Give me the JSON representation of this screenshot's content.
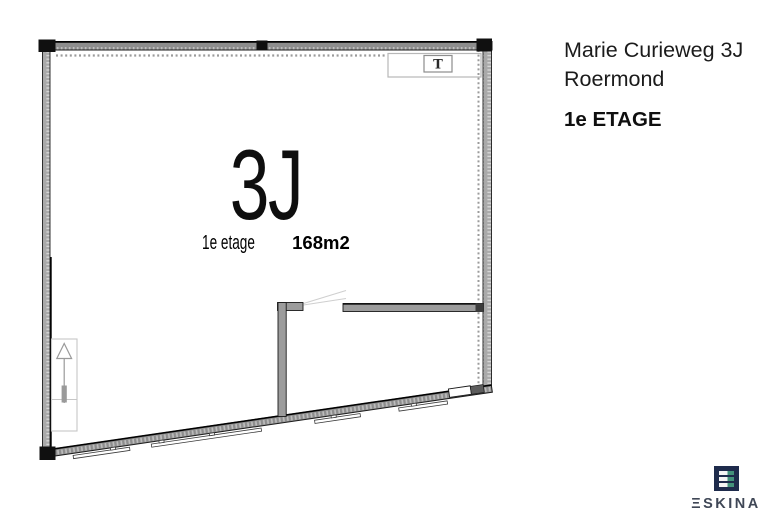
{
  "header": {
    "address_line1": "Marie Curieweg 3J",
    "address_line2": "Roermond",
    "floor_label": "1e ETAGE"
  },
  "plan": {
    "unit_label": "3J",
    "floor_text": "1e etage",
    "area_text": "168m2",
    "symbol_t": "T"
  },
  "logo": {
    "wordmark": "ΞSKINA",
    "brand_name": "ESKINA"
  },
  "colors": {
    "wall_gray": "#9c9c9c",
    "wall_hatch_light": "#d6d6d6",
    "marker_black": "#101010",
    "line_dark": "#1a1a1a",
    "dashed_guide": "#9b9b9b",
    "door_line": "#cfcfcf",
    "logo_navy": "#1e2b4c",
    "logo_green": "#44927c",
    "logo_text": "#3f4756",
    "text_black": "#1b1b1b"
  }
}
